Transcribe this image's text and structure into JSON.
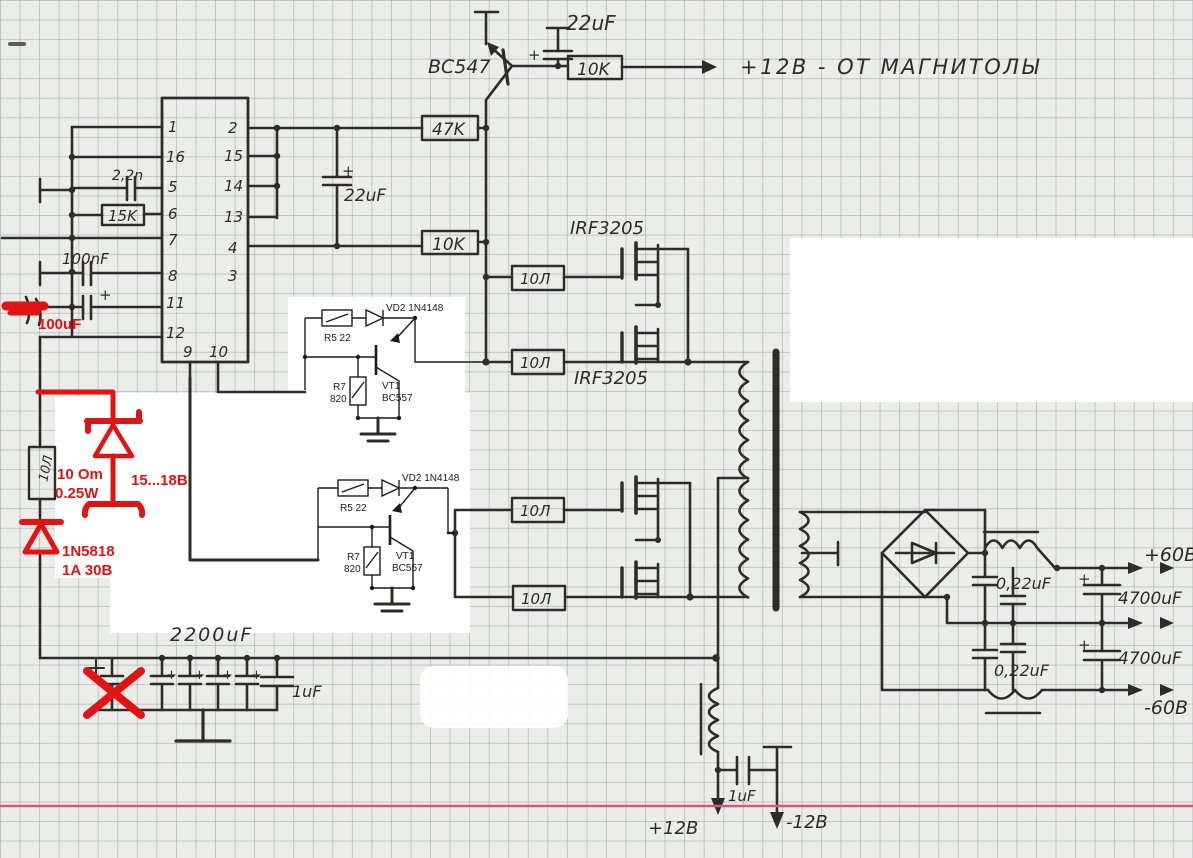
{
  "meta": {
    "title": "Hand-drawn push-pull DC-DC converter schematic (car amplifier PSU) on graph paper"
  },
  "labels": {
    "q1": "BC547",
    "c_top": "22uF",
    "r_top": "10K",
    "out_top": "+12В - ОТ МАГНИТОЛЫ",
    "r47": "47K",
    "c_mid": "22uF",
    "r10k": "10K",
    "c22n": "2,2n",
    "r15k": "15K",
    "c100n": "100nF",
    "irf": "IRF3205",
    "r10": "10Л",
    "c2200": "2200uF",
    "c1u": "1uF",
    "c022": "0,22uF",
    "c4700": "4700uF",
    "v60p": "+60В",
    "v60m": "-60В",
    "v12p": "+12В",
    "v12m": "-12В",
    "plus": "+"
  },
  "pins": {
    "left": [
      "1",
      "16",
      "5",
      "6",
      "7",
      "8",
      "11",
      "12"
    ],
    "right": [
      "2",
      "15",
      "14",
      "13",
      "4",
      "3"
    ],
    "bottom": [
      "9",
      "10"
    ]
  },
  "printed": {
    "r5": "R5 22",
    "vd2": "VD2 1N4148",
    "vt1": "VT1",
    "q": "BC557",
    "r7": "R7",
    "r7v": "820"
  },
  "red": {
    "c100u": "100uF",
    "r_val": "10 Om",
    "r_pw": "0.25W",
    "vz": "15...18B",
    "d": "1N5818",
    "d_r": "1A 30B"
  },
  "colors": {
    "pen": "#2e2c27",
    "printed": "#1c1c1c",
    "red_annotation": "#e11414",
    "pink_scan_line": "#e4517e",
    "paper": "#ecedea"
  }
}
